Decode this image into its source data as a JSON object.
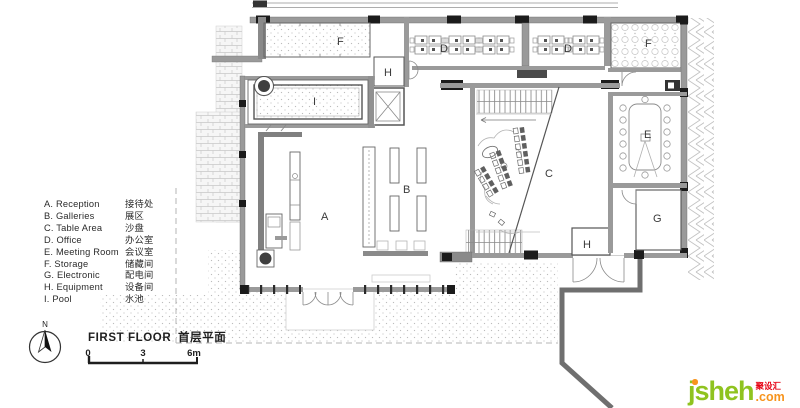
{
  "legend": {
    "items": [
      {
        "en": "A. Reception",
        "zh": "接待处"
      },
      {
        "en": "B. Galleries",
        "zh": "展区"
      },
      {
        "en": "C. Table Area",
        "zh": "沙盘"
      },
      {
        "en": "D. Office",
        "zh": "办公室"
      },
      {
        "en": "E. Meeting Room",
        "zh": "会议室"
      },
      {
        "en": "F. Storage",
        "zh": "储藏间"
      },
      {
        "en": "G. Electronic",
        "zh": "配电间"
      },
      {
        "en": "H. Equipment",
        "zh": "设备间"
      },
      {
        "en": "I. Pool",
        "zh": "水池"
      }
    ]
  },
  "plan": {
    "labels": [
      {
        "room": "storage-top-left",
        "text": "F"
      },
      {
        "room": "equipment-top",
        "text": "H"
      },
      {
        "room": "office-left",
        "text": "D"
      },
      {
        "room": "office-right",
        "text": "D"
      },
      {
        "room": "storage-top-right",
        "text": "F"
      },
      {
        "room": "pool",
        "text": "I"
      },
      {
        "room": "reception",
        "text": "A"
      },
      {
        "room": "galleries",
        "text": "B"
      },
      {
        "room": "table-area",
        "text": "C"
      },
      {
        "room": "meeting-room",
        "text": "E"
      },
      {
        "room": "electronic",
        "text": "G"
      },
      {
        "room": "equipment-bottom",
        "text": "H"
      }
    ]
  },
  "titleblock": {
    "north": "N",
    "title_en": "FIRST FLOOR",
    "title_zh": "首层平面",
    "scale_ticks": [
      "0",
      "3",
      "6m"
    ]
  },
  "watermark": {
    "name": "jsheh",
    "tld": ".com",
    "zh": "聚设汇",
    "color_name": "#8fc31f",
    "color_tld": "#f7941d",
    "color_zh": "#e60012"
  }
}
